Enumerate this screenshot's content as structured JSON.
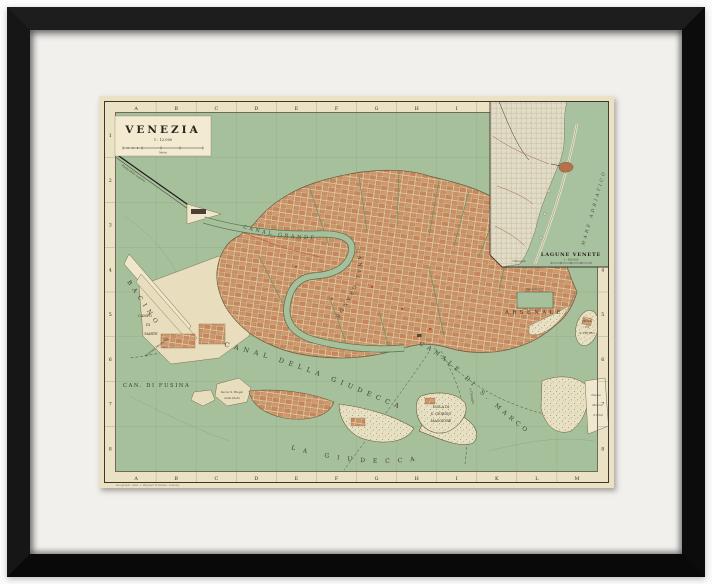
{
  "artwork": {
    "type": "framed-antique-map",
    "title_block": {
      "title": "VENEZIA",
      "scale": "1 : 12.000",
      "scale_unit": "Metri"
    },
    "grid": {
      "top": [
        "A",
        "B",
        "C",
        "D",
        "E",
        "F",
        "G",
        "H",
        "I"
      ],
      "bottom": [
        "A",
        "B",
        "C",
        "D",
        "E",
        "F",
        "G",
        "H",
        "I",
        "K",
        "L",
        "M"
      ],
      "left": [
        "1",
        "2",
        "3",
        "4",
        "5",
        "6",
        "7",
        "8"
      ],
      "right": [
        "1",
        "2",
        "3",
        "4",
        "5",
        "6",
        "7",
        "8"
      ]
    },
    "labels": {
      "canal_grande_upper": "CANAL GRANDE",
      "canal_grande_lower": "CANAL GRANDE",
      "canale_di_s_marco": "CANALE DI S. MARCO",
      "canal_della_giudecca": "CANAL DELLA GIUDECCA",
      "can_di_fusina": "CAN. DI FUSINA",
      "bacino": "BACINO",
      "campo_di_marte": [
        "CAMPO",
        "DI",
        "MARTE"
      ],
      "arsenale": "ARSENALE",
      "darsena": "Darsena Gr.",
      "la_giudecca": "LA GIUDECCA",
      "isola_s_giorgio": [
        "ISOLA DI",
        "S. GIORGIO",
        "MAGGIORE"
      ],
      "isola_s_pietro": [
        "ISOLA",
        "DI",
        "S. PIETRO"
      ],
      "nuova_piazza": [
        "Nuova",
        "Piazza",
        "d'armi"
      ],
      "ponte_della_laguna": "Ponte della Laguna",
      "sacca_biagio": [
        "Sacca S. Biagio",
        "della Pietà"
      ],
      "stazione_marittima": "Stazione Marittima",
      "a_chioggia": "a Chioggia"
    },
    "inset": {
      "title": "LAGUNE VENETE",
      "scale": "1 : 500.000",
      "sea": "MARE ADRIATICO",
      "place": "Chioggia"
    },
    "imprint": "Geograph. Anst. v. Wagner & Debes, Leipzig.",
    "colors": {
      "frame": "#111111",
      "mat": "#f2f0ed",
      "paper": "#ebe2c6",
      "lagoon": "#a6c09b",
      "urban_block": "#cf9166",
      "garden_base": "#e7e0c2",
      "border_line": "#3d362c",
      "red_accent": "#b94a33"
    }
  }
}
